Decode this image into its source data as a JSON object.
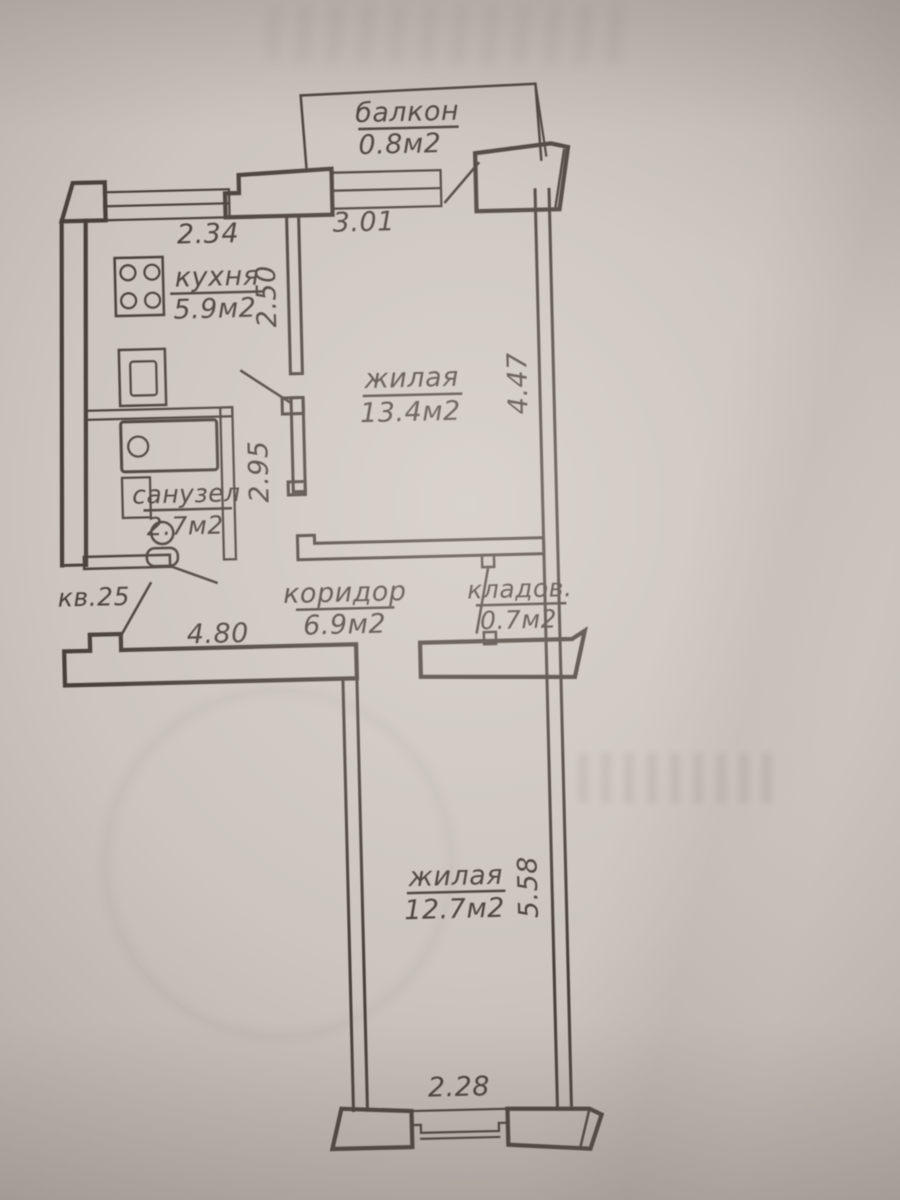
{
  "plan": {
    "apartment_label": "кв.25",
    "rooms": {
      "balcony": {
        "name": "балкон",
        "area": "0.8м2"
      },
      "kitchen": {
        "name": "кухня",
        "area": "5.9м2"
      },
      "living1": {
        "name": "жилая",
        "area": "13.4м2"
      },
      "bathroom": {
        "name": "санузел",
        "area": "2.7м2"
      },
      "corridor": {
        "name": "коридор",
        "area": "6.9м2"
      },
      "storage": {
        "name": "кладов.",
        "area": "0.7м2"
      },
      "living2": {
        "name": "жилая",
        "area": "12.7м2"
      }
    },
    "dims": {
      "kitchen_window": "2.34",
      "living_window": "3.01",
      "kitchen_depth": "2.50",
      "partition": "2.95",
      "living_depth": "4.47",
      "corridor": "4.80",
      "living2_depth": "5.58",
      "living2_window": "2.28"
    },
    "colors": {
      "ink": "#362e27",
      "paper": "#c9c3bc"
    }
  }
}
